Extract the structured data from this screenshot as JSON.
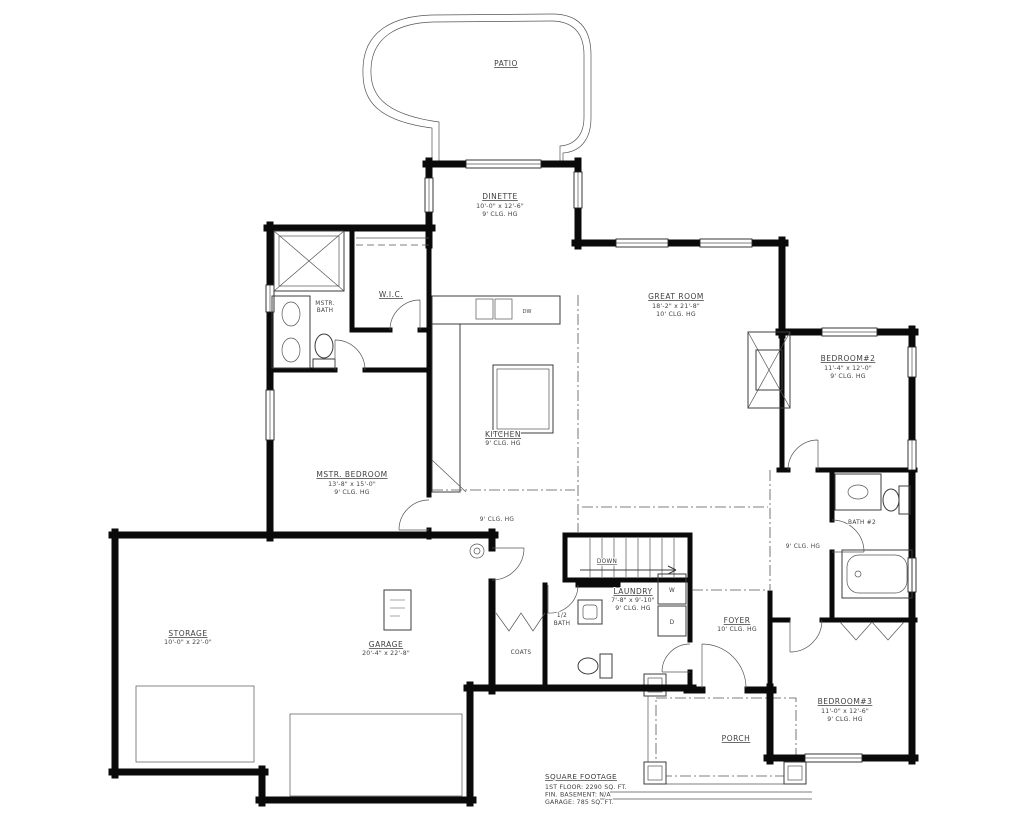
{
  "plan": {
    "rooms": {
      "patio": {
        "name": "PATIO"
      },
      "dinette": {
        "name": "DINETTE",
        "dims": "10'-0\" x 12'-6\"",
        "clg": "9' CLG. HG"
      },
      "great_room": {
        "name": "GREAT ROOM",
        "dims": "18'-2\" x 21'-8\"",
        "clg": "10' CLG. HG"
      },
      "bedroom2": {
        "name": "BEDROOM#2",
        "dims": "11'-4\" x 12'-0\"",
        "clg": "9' CLG. HG"
      },
      "mstr_bath": {
        "line1": "MSTR.",
        "line2": "BATH"
      },
      "wic": {
        "name": "W.I.C."
      },
      "kitchen": {
        "name": "KITCHEN",
        "clg": "9' CLG. HG"
      },
      "mstr_bedroom": {
        "name": "MSTR. BEDROOM",
        "dims": "13'-8\" x 15'-0\"",
        "clg": "9' CLG. HG"
      },
      "storage": {
        "name": "STORAGE",
        "dims": "10'-0\" x 22'-0\""
      },
      "garage": {
        "name": "GARAGE",
        "dims": "20'-4\" x 22'-8\""
      },
      "laundry": {
        "name": "LAUNDRY",
        "dims": "7'-8\" x 9'-10\"",
        "clg": "9' CLG. HG"
      },
      "half_bath": {
        "line1": "1/2",
        "line2": "BATH"
      },
      "coats": {
        "name": "COATS"
      },
      "foyer": {
        "name": "FOYER",
        "clg": "10' CLG. HG"
      },
      "bath2": {
        "name": "BATH #2"
      },
      "bedroom3": {
        "name": "BEDROOM#3",
        "dims": "11'-0\" x 12'-6\"",
        "clg": "9' CLG. HG"
      },
      "porch": {
        "name": "PORCH"
      }
    },
    "annotations": {
      "hall_clg_left": "9' CLG. HG",
      "hall_clg_right": "9' CLG. HG",
      "down": "DOWN",
      "dw": "DW",
      "washer": "W",
      "dryer": "D"
    },
    "square_footage": {
      "title": "SQUARE FOOTAGE",
      "first_floor": "1ST FLOOR: 2290 SQ. FT.",
      "basement": "FIN. BASEMENT: N/A",
      "garage": "GARAGE: 785 SQ. FT."
    },
    "colors": {
      "line": "#0a0a0a",
      "text": "#3f3f3f",
      "background": "#ffffff"
    }
  }
}
